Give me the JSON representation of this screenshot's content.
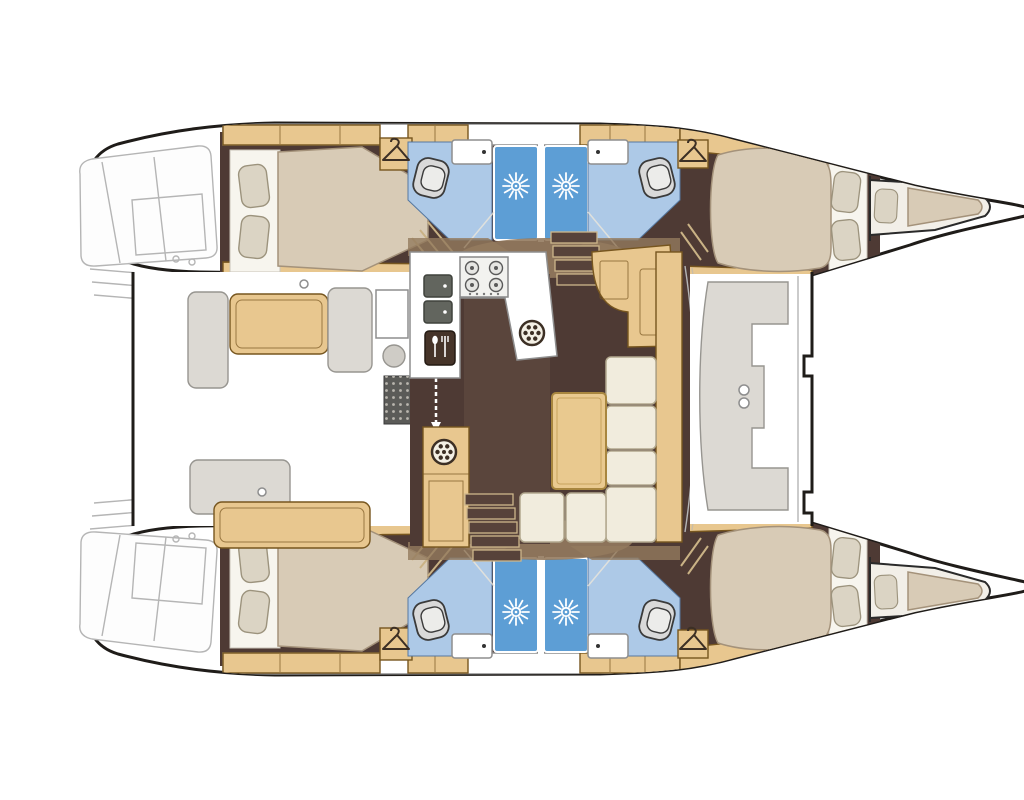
{
  "title": "Catamaran yacht interior floor plan (top-down deck layout)",
  "palette": {
    "hull_outline": "#1f1c19",
    "sketch": "#b5b5b5",
    "floor_dark": "#4e3a34",
    "floor_light": "#937a5e",
    "wood": "#e8c78f",
    "wood_dark": "#c8a25d",
    "wood_outline": "#77561f",
    "cream": "#f1ecdd",
    "cream_outline": "#b2a88e",
    "mattress": "#d8cbb6",
    "mattress_outline": "#a4927a",
    "pillow": "#dbd4c4",
    "bath_floor": "#adc9e7",
    "shower_blue": "#5d9ed5",
    "fixture": "#d9d9d9",
    "gray_seat": "#dcd9d3",
    "grate": "#5b5b58",
    "icon_dark": "#3c2f24"
  },
  "boat": {
    "orientation": {
      "bow": "right",
      "stern": "left"
    },
    "symmetry": "two mirrored hulls (top and bottom) joined by a central bridgedeck",
    "hull_rooms": [
      {
        "name": "aft double cabin",
        "furniture": [
          "double bed",
          "2 pillows",
          "hanger wardrobe"
        ]
      },
      {
        "name": "aft head",
        "fixtures": [
          "toilet",
          "washbasin",
          "shower stall with drain"
        ]
      },
      {
        "name": "forward head",
        "fixtures": [
          "shower stall with drain",
          "washbasin",
          "toilet"
        ]
      },
      {
        "name": "forward double cabin",
        "furniture": [
          "double bed",
          "2 pillows",
          "hanger wardrobe",
          "shelf lockers"
        ]
      },
      {
        "name": "forepeak berth",
        "furniture": [
          "single berth",
          "pillow"
        ]
      }
    ],
    "bridgedeck_rooms": [
      {
        "name": "aft cockpit",
        "furniture": [
          "bench seats",
          "gray helm seats",
          "side console",
          "deck grate",
          "sliding door arrows"
        ]
      },
      {
        "name": "galley",
        "fixtures": [
          "4-burner stove",
          "double sink",
          "refrigerator",
          "round sink hatch",
          "storage cabinet"
        ]
      },
      {
        "name": "salon",
        "furniture": [
          "L-shaped sofa",
          "coffee table",
          "nav station desk"
        ]
      },
      {
        "name": "companionway stairs",
        "count": 2
      },
      {
        "name": "forward cockpit",
        "furniture": [
          "C-shaped bench"
        ]
      },
      {
        "name": "trampoline area",
        "furniture": []
      },
      {
        "name": "stern transom steps",
        "count": 2
      }
    ],
    "icons": [
      "hanger-icon",
      "shower-drain-sun-icon",
      "stove-burner-icon",
      "fork-spoon-icon",
      "hatch-wheel-icon",
      "double-arrow-icon"
    ]
  }
}
